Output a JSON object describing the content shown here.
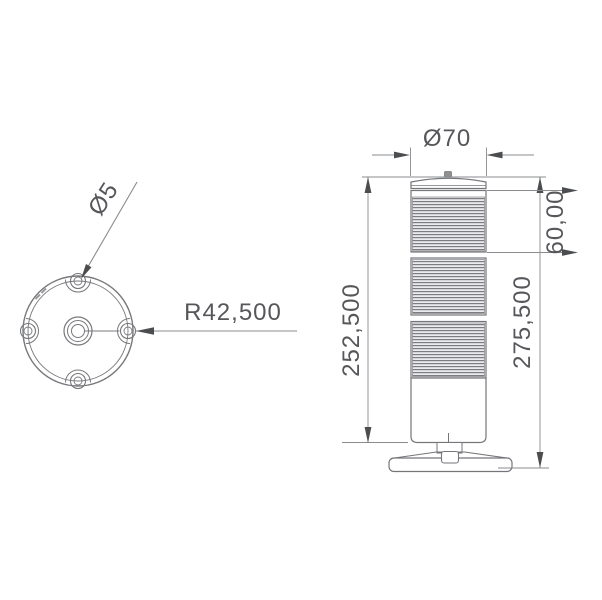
{
  "drawing": {
    "type": "technical-dimension-drawing",
    "subject": "signal tower with mounting base plate",
    "colors": {
      "background": "#ffffff",
      "line": "#77787b",
      "thin_line": "#8a8b8e",
      "text": "#56575a",
      "arrow": "#4c4d4f",
      "rib_dark": "#7c7d80",
      "rib_light": "#ebebed"
    },
    "top_view": {
      "description": "circular base plate with 4 holes and center hub",
      "labels": {
        "hole_diameter": "Ø5",
        "mount_radius": "R42,500"
      }
    },
    "front_view": {
      "description": "3-segment ribbed tower on base",
      "labels": {
        "diameter": "Ø70",
        "segment_height": "60,00",
        "body_height": "252,500",
        "total_height": "275,500"
      }
    }
  }
}
